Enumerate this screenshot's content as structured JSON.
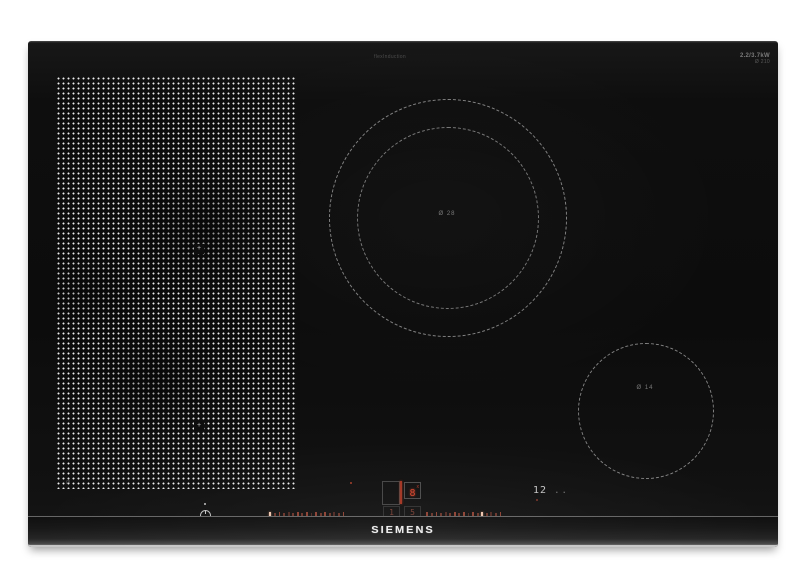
{
  "branding": {
    "logo": "SIEMENS"
  },
  "markings": {
    "top_center": "flexInduction",
    "top_right_line1": "2.2/3.7kW",
    "top_right_line2": "Ø 210",
    "flex_zone_corner": "Ø",
    "flex_zone_marker_top": "+",
    "flex_zone_marker_bottom": "+",
    "large_zone_center": "Ø 28",
    "small_zone_center": "Ø 14"
  },
  "controls": {
    "display": {
      "power_level": "8",
      "power_level_suffix": "x",
      "left_digit": "1",
      "right_digit": "5"
    },
    "timer_value": "12",
    "timer_dots": "..",
    "slider_left": {
      "count": 17,
      "bright_index": 0
    },
    "slider_right": {
      "count": 17,
      "bright_index": 12
    }
  },
  "colors": {
    "glass_black": "#0d0d0d",
    "indicator_red": "#b04a38",
    "dot_white": "#ececec",
    "logo_white": "#ededed"
  }
}
